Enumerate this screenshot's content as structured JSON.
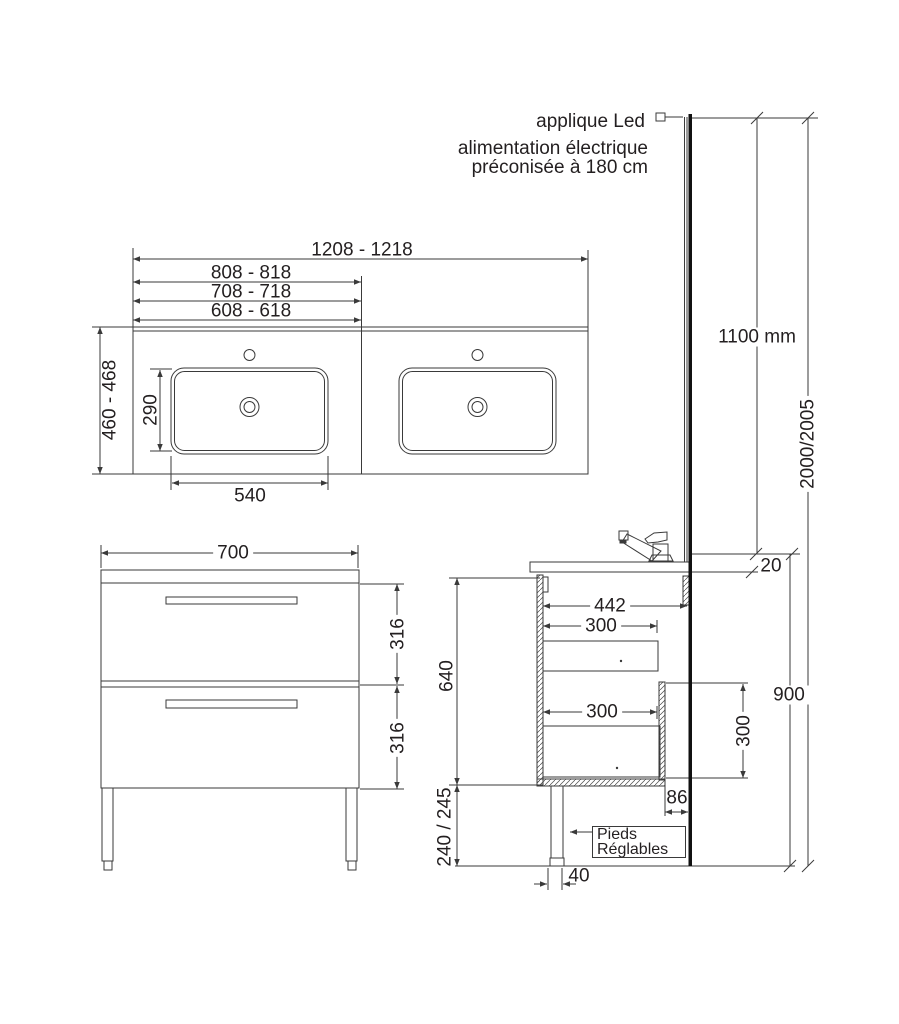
{
  "title_notes": {
    "applique": "applique Led",
    "alimentation_line1": "alimentation électrique",
    "alimentation_line2": "préconisée à 180 cm"
  },
  "plan_view": {
    "total_width": "1208 - 1218",
    "width_option_3": "808 - 818",
    "width_option_2": "708 - 718",
    "width_option_1": "608 - 618",
    "depth": "460 - 468",
    "basin_inner_depth": "290",
    "basin_inner_width": "540"
  },
  "front_view": {
    "cabinet_width": "700",
    "upper_drawer_height": "316",
    "lower_drawer_height": "316"
  },
  "side_view": {
    "cabinet_depth": "442",
    "upper_drawer_depth": "300",
    "lower_drawer_depth": "300",
    "cabinet_height": "640",
    "leg_height": "240 / 245",
    "back_recess_depth": "86",
    "foot_width": "40",
    "countertop_thickness": "20",
    "back_panel_height": "300",
    "worktop_height": "900",
    "feet_label_line1": "Pieds",
    "feet_label_line2": "Réglables"
  },
  "elevation": {
    "mirror_height": "1100 mm",
    "total_height": "2000/2005"
  },
  "colors": {
    "line": "#3a3a3a",
    "accent_thick": "#111111",
    "text": "#231f20",
    "background": "#ffffff"
  }
}
